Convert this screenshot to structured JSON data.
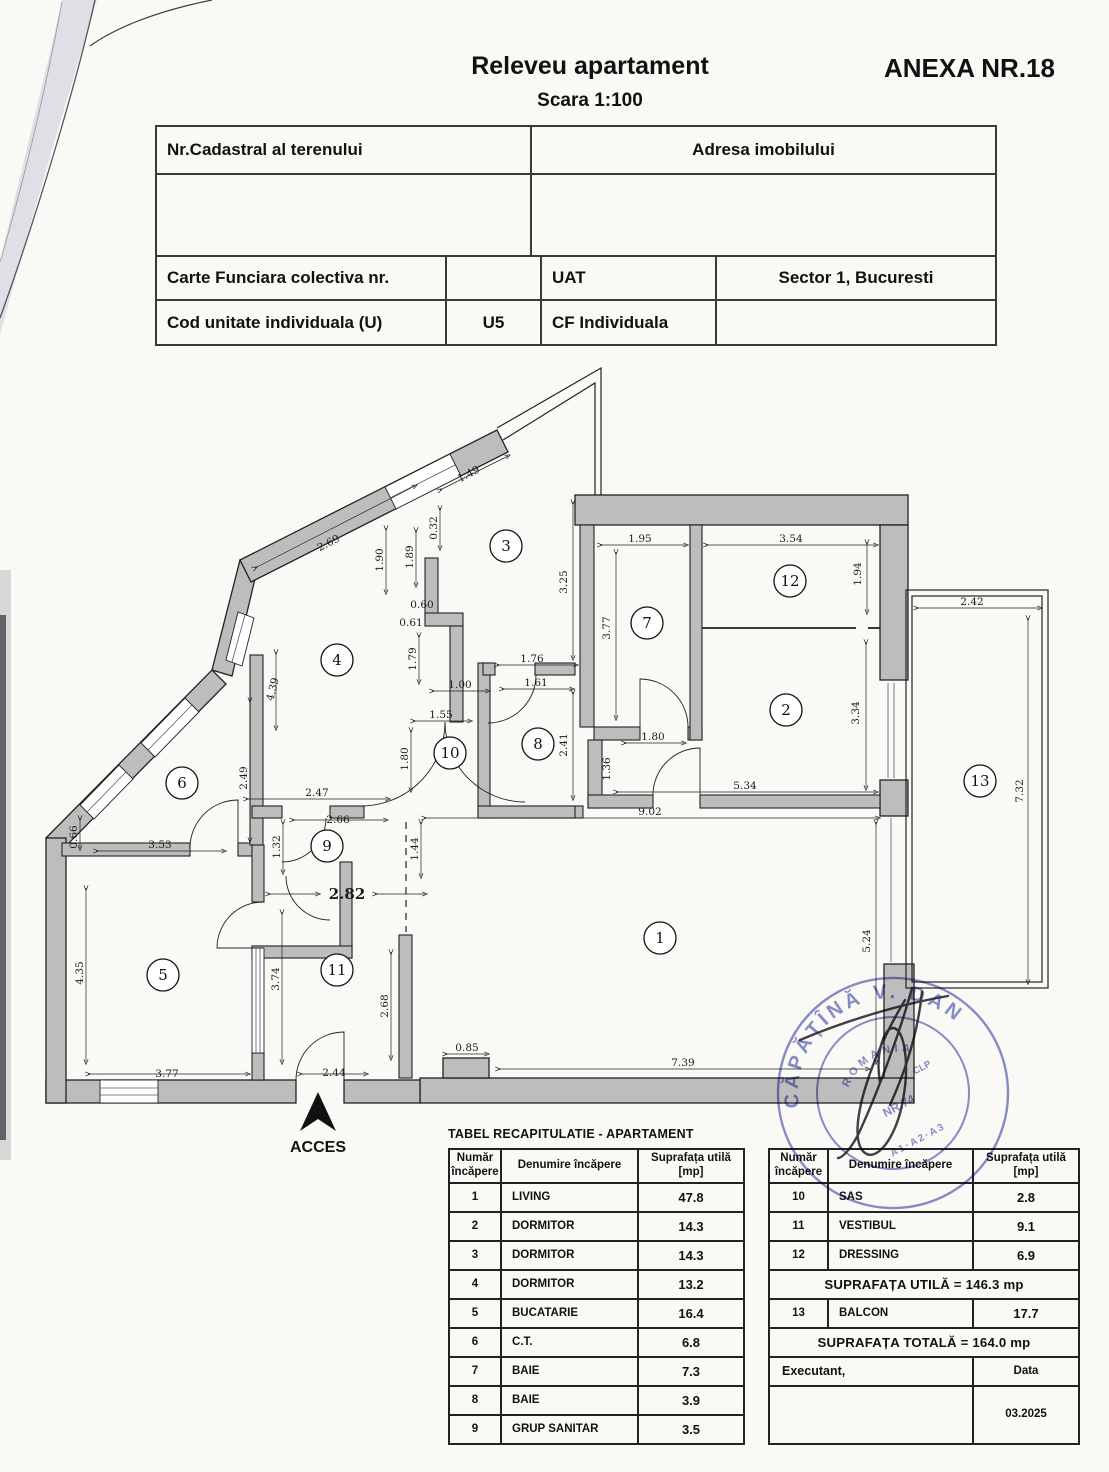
{
  "page": {
    "title": "Releveu apartament",
    "scale": "Scara 1:100",
    "annex": "ANEXA NR.18"
  },
  "info_table": {
    "cadastral_label": "Nr.Cadastral al terenului",
    "address_label": "Adresa imobilului",
    "cf_label": "Carte Funciara colectiva nr.",
    "cf_value": "",
    "uat_label": "UAT",
    "uat_value": "Sector 1, Bucuresti",
    "unit_label": "Cod unitate individuala (U)",
    "unit_value": "U5",
    "cfi_label": "CF Individuala",
    "cfi_value": ""
  },
  "plan": {
    "acces": "ACCES",
    "rooms": [
      {
        "n": "1"
      },
      {
        "n": "2"
      },
      {
        "n": "3"
      },
      {
        "n": "4"
      },
      {
        "n": "5"
      },
      {
        "n": "6"
      },
      {
        "n": "7"
      },
      {
        "n": "8"
      },
      {
        "n": "9"
      },
      {
        "n": "10"
      },
      {
        "n": "11"
      },
      {
        "n": "12"
      },
      {
        "n": "13"
      }
    ],
    "dims": [
      {
        "t": "2.69"
      },
      {
        "t": "1.49"
      },
      {
        "t": "0.32"
      },
      {
        "t": "1.90"
      },
      {
        "t": "1.89"
      },
      {
        "t": "0.60"
      },
      {
        "t": "0.61"
      },
      {
        "t": "1.79"
      },
      {
        "t": "4.39"
      },
      {
        "t": "2.49"
      },
      {
        "t": "0.66"
      },
      {
        "t": "3.53"
      },
      {
        "t": "4.35"
      },
      {
        "t": "3.77"
      },
      {
        "t": "3.74"
      },
      {
        "t": "2.44"
      },
      {
        "t": "2.68"
      },
      {
        "t": "2.82"
      },
      {
        "t": "2.66"
      },
      {
        "t": "1.32"
      },
      {
        "t": "2.47"
      },
      {
        "t": "1.44"
      },
      {
        "t": "1.55"
      },
      {
        "t": "1.00"
      },
      {
        "t": "1.80"
      },
      {
        "t": "1.76"
      },
      {
        "t": "1.61"
      },
      {
        "t": "2.41"
      },
      {
        "t": "3.25"
      },
      {
        "t": "1.95"
      },
      {
        "t": "3.77"
      },
      {
        "t": "3.54"
      },
      {
        "t": "1.94"
      },
      {
        "t": "3.34"
      },
      {
        "t": "1.80"
      },
      {
        "t": "1.36"
      },
      {
        "t": "5.34"
      },
      {
        "t": "9.02"
      },
      {
        "t": "2.42"
      },
      {
        "t": "7.32"
      },
      {
        "t": "5.24"
      },
      {
        "t": "0.85"
      },
      {
        "t": "7.39"
      }
    ]
  },
  "recap": {
    "title": "TABEL RECAPITULATIE - APARTAMENT",
    "headers": {
      "num": "Număr încăpere",
      "name": "Denumire încăpere",
      "area": "Suprafața utilă [mp]"
    },
    "left_rows": [
      [
        "1",
        "LIVING",
        "47.8"
      ],
      [
        "2",
        "DORMITOR",
        "14.3"
      ],
      [
        "3",
        "DORMITOR",
        "14.3"
      ],
      [
        "4",
        "DORMITOR",
        "13.2"
      ],
      [
        "5",
        "BUCATARIE",
        "16.4"
      ],
      [
        "6",
        "C.T.",
        "6.8"
      ],
      [
        "7",
        "BAIE",
        "7.3"
      ],
      [
        "8",
        "BAIE",
        "3.9"
      ],
      [
        "9",
        "GRUP SANITAR",
        "3.5"
      ]
    ],
    "right_rows": [
      [
        "10",
        "SAS",
        "2.8"
      ],
      [
        "11",
        "VESTIBUL",
        "9.1"
      ],
      [
        "12",
        "DRESSING",
        "6.9"
      ]
    ],
    "total_utila": "SUPRAFAȚA UTILĂ =  146.3  mp",
    "balcon_row": [
      "13",
      "BALCON",
      "17.7"
    ],
    "total": "SUPRAFAȚA TOTALĂ =  164.0  mp",
    "executant": "Executant,",
    "data_label": "Data",
    "date": "03.2025"
  },
  "stamp": {
    "name": "CĂPĂȚÎNĂ  V.  DAN",
    "country": "ROMANIA",
    "code": "NR.74",
    "cat": "CLP",
    "series": "A1·A2·A3"
  }
}
